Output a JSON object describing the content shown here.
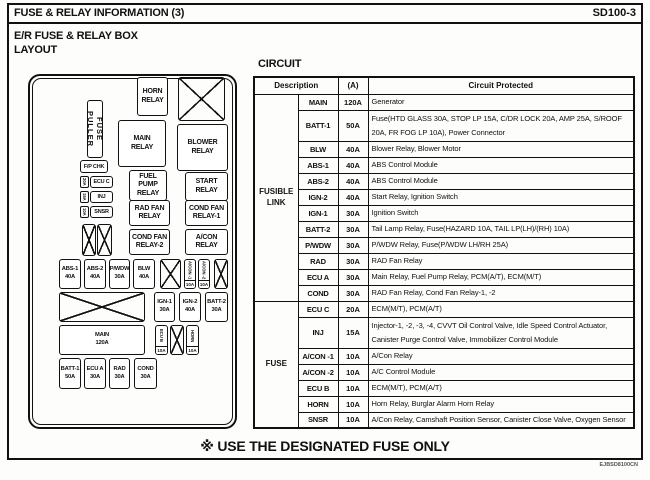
{
  "header": {
    "title": "FUSE & RELAY INFORMATION (3)",
    "code": "SD100-3"
  },
  "layout_panel": {
    "heading": "E/R FUSE & RELAY BOX\nLAYOUT",
    "boxes": [
      {
        "id": "fuse-puller",
        "type": "vlabel",
        "x": 57,
        "y": 24,
        "w": 16,
        "h": 58,
        "label": "FUSE PULLER"
      },
      {
        "id": "horn-relay",
        "type": "relay",
        "x": 107,
        "y": 1,
        "w": 31,
        "h": 39,
        "label": "HORN\nRELAY"
      },
      {
        "id": "blank-top",
        "type": "x",
        "x": 148,
        "y": 1,
        "w": 47,
        "h": 44,
        "label": ""
      },
      {
        "id": "main-relay",
        "type": "relay",
        "x": 88,
        "y": 44,
        "w": 48,
        "h": 47,
        "label": "MAIN\nRELAY"
      },
      {
        "id": "blower-relay",
        "type": "relay",
        "x": 147,
        "y": 48,
        "w": 51,
        "h": 47,
        "label": "BLOWER\nRELAY"
      },
      {
        "id": "fp-chk",
        "type": "small",
        "x": 50,
        "y": 84,
        "w": 28,
        "h": 13,
        "label": "F/P CHK"
      },
      {
        "id": "ecu-c-amp",
        "type": "sideamp",
        "x": 50,
        "y": 100,
        "w": 9,
        "h": 12,
        "label": "20A"
      },
      {
        "id": "ecu-c",
        "type": "small",
        "x": 60,
        "y": 100,
        "w": 23,
        "h": 12,
        "label": "ECU C"
      },
      {
        "id": "inj-amp",
        "type": "sideamp",
        "x": 50,
        "y": 115,
        "w": 9,
        "h": 12,
        "label": "15A"
      },
      {
        "id": "inj",
        "type": "small",
        "x": 60,
        "y": 115,
        "w": 23,
        "h": 12,
        "label": "INJ"
      },
      {
        "id": "snsr-amp",
        "type": "sideamp",
        "x": 50,
        "y": 130,
        "w": 9,
        "h": 12,
        "label": "10A"
      },
      {
        "id": "snsr",
        "type": "small",
        "x": 60,
        "y": 130,
        "w": 23,
        "h": 12,
        "label": "SNSR"
      },
      {
        "id": "fuel-pump-relay",
        "type": "relay",
        "x": 99,
        "y": 94,
        "w": 38,
        "h": 31,
        "label": "FUEL\nPUMP\nRELAY"
      },
      {
        "id": "start-relay",
        "type": "relay",
        "x": 155,
        "y": 96,
        "w": 43,
        "h": 29,
        "label": "START\nRELAY"
      },
      {
        "id": "rad-fan-relay",
        "type": "relay",
        "x": 99,
        "y": 124,
        "w": 41,
        "h": 26,
        "label": "RAD FAN\nRELAY"
      },
      {
        "id": "cond-fan-relay-1",
        "type": "relay",
        "x": 155,
        "y": 124,
        "w": 43,
        "h": 26,
        "label": "COND FAN\nRELAY-1"
      },
      {
        "id": "blank-mid-1",
        "type": "x",
        "x": 52,
        "y": 148,
        "w": 14,
        "h": 32,
        "label": ""
      },
      {
        "id": "blank-mid-2",
        "type": "x",
        "x": 67,
        "y": 148,
        "w": 15,
        "h": 32,
        "label": ""
      },
      {
        "id": "cond-fan-relay-2",
        "type": "relay",
        "x": 99,
        "y": 153,
        "w": 41,
        "h": 26,
        "label": "COND FAN\nRELAY-2"
      },
      {
        "id": "acon-relay",
        "type": "relay",
        "x": 155,
        "y": 153,
        "w": 43,
        "h": 26,
        "label": "A/CON\nRELAY"
      },
      {
        "id": "abs-1",
        "type": "fuse",
        "x": 29,
        "y": 183,
        "w": 22,
        "h": 30,
        "label": "ABS-1\n40A"
      },
      {
        "id": "abs-2",
        "type": "fuse",
        "x": 54,
        "y": 183,
        "w": 22,
        "h": 30,
        "label": "ABS-2\n40A"
      },
      {
        "id": "pwdw",
        "type": "fuse",
        "x": 79,
        "y": 183,
        "w": 21,
        "h": 30,
        "label": "P/WDW\n30A"
      },
      {
        "id": "blw",
        "type": "fuse",
        "x": 103,
        "y": 183,
        "w": 22,
        "h": 30,
        "label": "BLW\n40A"
      },
      {
        "id": "blank-f1",
        "type": "x",
        "x": 130,
        "y": 183,
        "w": 21,
        "h": 30,
        "label": ""
      },
      {
        "id": "acon-1",
        "type": "vfuse",
        "x": 154,
        "y": 183,
        "w": 12,
        "h": 30,
        "label": "A/CON -1",
        "amp": "10A"
      },
      {
        "id": "acon-2",
        "type": "vfuse",
        "x": 168,
        "y": 183,
        "w": 12,
        "h": 30,
        "label": "A/CON -2",
        "amp": "10A"
      },
      {
        "id": "blank-f2",
        "type": "x",
        "x": 184,
        "y": 183,
        "w": 14,
        "h": 30,
        "label": ""
      },
      {
        "id": "blank-big",
        "type": "x",
        "x": 29,
        "y": 216,
        "w": 86,
        "h": 30,
        "label": ""
      },
      {
        "id": "ign-1",
        "type": "fuse",
        "x": 124,
        "y": 216,
        "w": 21,
        "h": 30,
        "label": "IGN-1\n30A"
      },
      {
        "id": "ign-2",
        "type": "fuse",
        "x": 149,
        "y": 216,
        "w": 22,
        "h": 30,
        "label": "IGN-2\n40A"
      },
      {
        "id": "batt-2",
        "type": "fuse",
        "x": 175,
        "y": 216,
        "w": 23,
        "h": 30,
        "label": "BATT-2\n30A"
      },
      {
        "id": "main-120",
        "type": "fuse",
        "x": 29,
        "y": 249,
        "w": 86,
        "h": 30,
        "label": "MAIN\n120A"
      },
      {
        "id": "ecu-b",
        "type": "vfuse",
        "x": 125,
        "y": 249,
        "w": 13,
        "h": 30,
        "label": "ECU B",
        "amp": "10A"
      },
      {
        "id": "blank-b1",
        "type": "x",
        "x": 140,
        "y": 249,
        "w": 14,
        "h": 30,
        "label": ""
      },
      {
        "id": "horn",
        "type": "vfuse",
        "x": 156,
        "y": 249,
        "w": 13,
        "h": 30,
        "label": "HORN",
        "amp": "10A"
      },
      {
        "id": "batt-1",
        "type": "fuse",
        "x": 29,
        "y": 282,
        "w": 22,
        "h": 31,
        "label": "BATT-1\n50A"
      },
      {
        "id": "ecu-a",
        "type": "fuse",
        "x": 54,
        "y": 282,
        "w": 22,
        "h": 31,
        "label": "ECU A\n30A"
      },
      {
        "id": "rad",
        "type": "fuse",
        "x": 79,
        "y": 282,
        "w": 21,
        "h": 31,
        "label": "RAD\n30A"
      },
      {
        "id": "cond",
        "type": "fuse",
        "x": 104,
        "y": 282,
        "w": 23,
        "h": 31,
        "label": "COND\n30A"
      }
    ]
  },
  "circuit_panel": {
    "heading": "CIRCUIT",
    "table": {
      "headers": {
        "description": "Description",
        "amps": "(A)",
        "circuit": "Circuit Protected"
      },
      "groups": [
        {
          "name": "FUSIBLE\nLINK",
          "rows": [
            {
              "name": "MAIN",
              "amp": "120A",
              "circuit": "Generator",
              "tall": false
            },
            {
              "name": "BATT-1",
              "amp": "50A",
              "circuit": "Fuse(HTD GLASS 30A, STOP LP 15A, C/DR LOCK 20A, AMP 25A, S/ROOF 20A, FR FOG LP 10A), Power Connector",
              "tall": true
            },
            {
              "name": "BLW",
              "amp": "40A",
              "circuit": "Blower Relay, Blower Motor",
              "tall": false
            },
            {
              "name": "ABS-1",
              "amp": "40A",
              "circuit": "ABS Control Module",
              "tall": false
            },
            {
              "name": "ABS-2",
              "amp": "40A",
              "circuit": "ABS Control Module",
              "tall": false
            },
            {
              "name": "IGN-2",
              "amp": "40A",
              "circuit": "Start Relay, Ignition Switch",
              "tall": false
            },
            {
              "name": "IGN-1",
              "amp": "30A",
              "circuit": "Ignition Switch",
              "tall": false
            },
            {
              "name": "BATT-2",
              "amp": "30A",
              "circuit": "Tail Lamp Relay, Fuse(HAZARD 10A, TAIL LP(LH)/(RH) 10A)",
              "tall": false
            },
            {
              "name": "P/WDW",
              "amp": "30A",
              "circuit": "P/WDW Relay, Fuse(P/WDW LH/RH 25A)",
              "tall": false
            },
            {
              "name": "RAD",
              "amp": "30A",
              "circuit": "RAD Fan Relay",
              "tall": false
            },
            {
              "name": "ECU A",
              "amp": "30A",
              "circuit": "Main Relay, Fuel Pump Relay, PCM(A/T), ECM(M/T)",
              "tall": false
            },
            {
              "name": "COND",
              "amp": "30A",
              "circuit": "RAD Fan Relay, Cond Fan Relay-1, -2",
              "tall": false
            }
          ]
        },
        {
          "name": "FUSE",
          "rows": [
            {
              "name": "ECU C",
              "amp": "20A",
              "circuit": "ECM(M/T), PCM(A/T)",
              "tall": false
            },
            {
              "name": "INJ",
              "amp": "15A",
              "circuit": "Injector-1, -2, -3, -4, CVVT Oil Control Valve, Idle Speed Control Actuator, Canister Purge Control Valve, Immobilizer Control Module",
              "tall": true
            },
            {
              "name": "A/CON -1",
              "amp": "10A",
              "circuit": "A/Con Relay",
              "tall": false
            },
            {
              "name": "A/CON -2",
              "amp": "10A",
              "circuit": "A/C Control Module",
              "tall": false
            },
            {
              "name": "ECU B",
              "amp": "10A",
              "circuit": "ECM(M/T), PCM(A/T)",
              "tall": false
            },
            {
              "name": "HORN",
              "amp": "10A",
              "circuit": "Horn Relay, Burglar Alarm Horn Relay",
              "tall": false
            },
            {
              "name": "SNSR",
              "amp": "10A",
              "circuit": "A/Con Relay, Camshaft Position Sensor, Canister Close Valve, Oxygen Sensor",
              "tall": false
            }
          ]
        }
      ]
    }
  },
  "footer": {
    "note": "※ USE THE DESIGNATED FUSE ONLY",
    "doc_code": "EJBSD8100CN"
  }
}
